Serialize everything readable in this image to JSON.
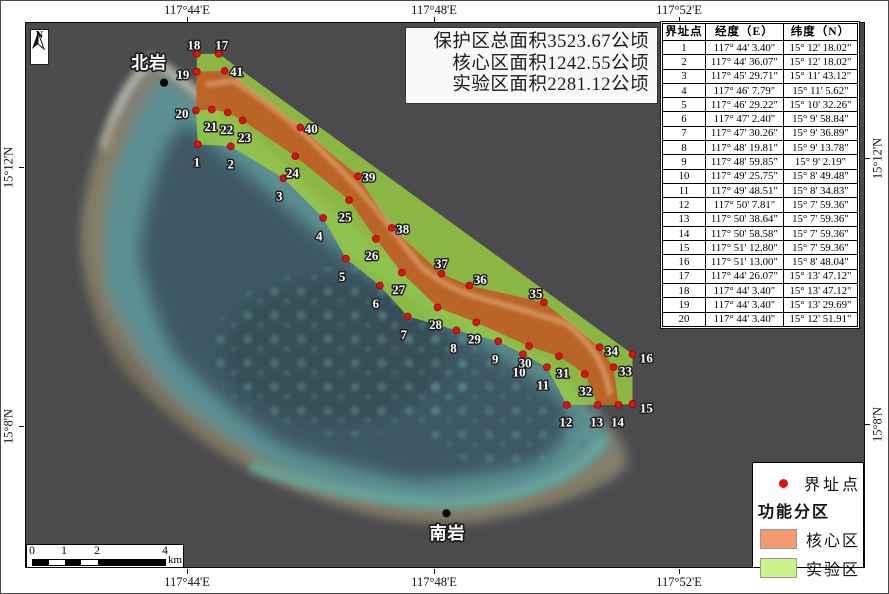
{
  "colors": {
    "map_background": "#4B4B4D",
    "core_zone_fill": "#BF5B25",
    "experimental_zone_fill": "#9BCE41",
    "legend_core_swatch": "#F49A73",
    "legend_experimental_swatch": "#CDF18A",
    "boundary_dot": "#DD1111"
  },
  "title_box": {
    "lines": [
      "保护区总面积3523.67公顷",
      "核心区面积1242.55公顷",
      "实验区面积2281.12公顷"
    ]
  },
  "north_arrow": {
    "label": "N"
  },
  "axes": {
    "top": [
      {
        "label": "117°44'E",
        "x": 187
      },
      {
        "label": "117°48'E",
        "x": 434
      },
      {
        "label": "117°52'E",
        "x": 679
      }
    ],
    "bottom": [
      {
        "label": "117°44'E",
        "x": 187
      },
      {
        "label": "117°48'E",
        "x": 434
      },
      {
        "label": "117°52'E",
        "x": 679
      }
    ],
    "left": [
      {
        "label": "15°12'N",
        "y": 167
      },
      {
        "label": "15°8'N",
        "y": 426
      }
    ],
    "right": [
      {
        "label": "15°12'N",
        "y": 158
      },
      {
        "label": "15°8'N",
        "y": 424
      }
    ]
  },
  "scale_bar": {
    "ticks": [
      {
        "label": "0",
        "x": 5
      },
      {
        "label": "1",
        "x": 37
      },
      {
        "label": "2",
        "x": 70
      },
      {
        "label": "4",
        "x": 138
      }
    ],
    "unit": "km",
    "segments": [
      {
        "x1": 5,
        "x2": 21
      },
      {
        "x1": 37,
        "x2": 53
      },
      {
        "x1": 70,
        "x2": 138
      }
    ]
  },
  "legend": {
    "point_label": "界址点",
    "group_title": "功能分区",
    "items": [
      {
        "label": "核心区",
        "color": "#F49A73"
      },
      {
        "label": "实验区",
        "color": "#CDF18A"
      }
    ]
  },
  "table": {
    "headers": [
      "界址点",
      "经度（E）",
      "纬度（N）"
    ],
    "rows": [
      [
        "1",
        "117° 44' 3.40\"",
        "15° 12' 18.02\""
      ],
      [
        "2",
        "117° 44' 36.07\"",
        "15° 12' 18.02\""
      ],
      [
        "3",
        "117° 45' 29.71\"",
        "15° 11' 43.12\""
      ],
      [
        "4",
        "117° 46' 7.79\"",
        "15° 11' 5.62\""
      ],
      [
        "5",
        "117° 46' 29.22\"",
        "15° 10' 32.26\""
      ],
      [
        "6",
        "117° 47' 2.40\"",
        "15° 9' 58.84\""
      ],
      [
        "7",
        "117° 47' 30.26\"",
        "15° 9' 36.89\""
      ],
      [
        "8",
        "117° 48' 19.81\"",
        "15° 9' 13.78\""
      ],
      [
        "9",
        "117° 48' 59.85\"",
        "15° 9' 2.19\""
      ],
      [
        "10",
        "117° 49' 25.75\"",
        "15° 8' 49.48\""
      ],
      [
        "11",
        "117° 49' 48.51\"",
        "15° 8' 34.83\""
      ],
      [
        "12",
        "117° 50' 7.81\"",
        "15° 7' 59.36\""
      ],
      [
        "13",
        "117° 50' 38.64\"",
        "15° 7' 59.36\""
      ],
      [
        "14",
        "117° 50' 58.58\"",
        "15° 7' 59.36\""
      ],
      [
        "15",
        "117° 51' 12.80\"",
        "15° 7' 59.36\""
      ],
      [
        "16",
        "117° 51' 13.00\"",
        "15° 8' 48.04\""
      ],
      [
        "17",
        "117° 44' 26.07\"",
        "15° 13' 47.12\""
      ],
      [
        "18",
        "117° 44' 3.40\"",
        "15° 13' 47.12\""
      ],
      [
        "19",
        "117° 44' 3.40\"",
        "15° 13' 29.69\""
      ],
      [
        "20",
        "117° 44' 3.40\"",
        "15° 12' 51.91\""
      ]
    ]
  },
  "map": {
    "zones": {
      "experimental_points": "171,31 193,31 609,333 609,383 595,384 574,384 543,384 523,346 499,333 474,320 432,309 383,295 355,264 321,237 298,196 258,156 205,124 172,122 170,88 171,49",
      "core_points": "171,49 199,48 275,105 333,154 367,206 417,252 445,264 520,281 576,326 590,346 595,384 574,384 561,353 535,335 505,325 452,301 413,286 377,251 351,217 324,178 270,134 217,98 202,90 186,87 170,88"
    },
    "boundary_points": [
      {
        "n": "1",
        "x": 172,
        "y": 122,
        "lx": 171,
        "ly": 140
      },
      {
        "n": "2",
        "x": 205,
        "y": 124,
        "lx": 205,
        "ly": 142
      },
      {
        "n": "3",
        "x": 258,
        "y": 156,
        "lx": 254,
        "ly": 174
      },
      {
        "n": "4",
        "x": 298,
        "y": 196,
        "lx": 294,
        "ly": 214
      },
      {
        "n": "5",
        "x": 321,
        "y": 237,
        "lx": 317,
        "ly": 255
      },
      {
        "n": "6",
        "x": 355,
        "y": 264,
        "lx": 351,
        "ly": 282
      },
      {
        "n": "7",
        "x": 383,
        "y": 295,
        "lx": 379,
        "ly": 313
      },
      {
        "n": "8",
        "x": 432,
        "y": 309,
        "lx": 429,
        "ly": 327
      },
      {
        "n": "9",
        "x": 474,
        "y": 320,
        "lx": 471,
        "ly": 338
      },
      {
        "n": "10",
        "x": 499,
        "y": 333,
        "lx": 495,
        "ly": 351
      },
      {
        "n": "11",
        "x": 523,
        "y": 346,
        "lx": 519,
        "ly": 364
      },
      {
        "n": "12",
        "x": 543,
        "y": 384,
        "lx": 542,
        "ly": 401
      },
      {
        "n": "13",
        "x": 574,
        "y": 384,
        "lx": 573,
        "ly": 401
      },
      {
        "n": "14",
        "x": 595,
        "y": 384,
        "lx": 594,
        "ly": 401
      },
      {
        "n": "15",
        "x": 609,
        "y": 383,
        "lx": 623,
        "ly": 387
      },
      {
        "n": "16",
        "x": 609,
        "y": 333,
        "lx": 623,
        "ly": 337
      },
      {
        "n": "17",
        "x": 193,
        "y": 31,
        "lx": 196,
        "ly": 22
      },
      {
        "n": "18",
        "x": 171,
        "y": 31,
        "lx": 168,
        "ly": 22
      },
      {
        "n": "19",
        "x": 171,
        "y": 49,
        "lx": 157,
        "ly": 52
      },
      {
        "n": "20",
        "x": 170,
        "y": 88,
        "lx": 156,
        "ly": 91
      },
      {
        "n": "21",
        "x": 186,
        "y": 87,
        "lx": 185,
        "ly": 104
      },
      {
        "n": "22",
        "x": 202,
        "y": 90,
        "lx": 201,
        "ly": 107
      },
      {
        "n": "23",
        "x": 217,
        "y": 98,
        "lx": 219,
        "ly": 115
      },
      {
        "n": "24",
        "x": 270,
        "y": 134,
        "lx": 267,
        "ly": 151
      },
      {
        "n": "25",
        "x": 324,
        "y": 178,
        "lx": 320,
        "ly": 195
      },
      {
        "n": "26",
        "x": 351,
        "y": 217,
        "lx": 347,
        "ly": 234
      },
      {
        "n": "27",
        "x": 377,
        "y": 251,
        "lx": 374,
        "ly": 268
      },
      {
        "n": "28",
        "x": 413,
        "y": 286,
        "lx": 411,
        "ly": 303
      },
      {
        "n": "29",
        "x": 452,
        "y": 301,
        "lx": 450,
        "ly": 318
      },
      {
        "n": "30",
        "x": 505,
        "y": 325,
        "lx": 501,
        "ly": 342
      },
      {
        "n": "31",
        "x": 535,
        "y": 335,
        "lx": 539,
        "ly": 352
      },
      {
        "n": "32",
        "x": 561,
        "y": 353,
        "lx": 562,
        "ly": 370
      },
      {
        "n": "33",
        "x": 590,
        "y": 346,
        "lx": 602,
        "ly": 350
      },
      {
        "n": "34",
        "x": 576,
        "y": 326,
        "lx": 588,
        "ly": 330
      },
      {
        "n": "35",
        "x": 520,
        "y": 281,
        "lx": 512,
        "ly": 272
      },
      {
        "n": "36",
        "x": 445,
        "y": 264,
        "lx": 456,
        "ly": 258
      },
      {
        "n": "37",
        "x": 417,
        "y": 252,
        "lx": 417,
        "ly": 242
      },
      {
        "n": "38",
        "x": 367,
        "y": 206,
        "lx": 378,
        "ly": 207
      },
      {
        "n": "39",
        "x": 333,
        "y": 154,
        "lx": 344,
        "ly": 155
      },
      {
        "n": "40",
        "x": 275,
        "y": 105,
        "lx": 286,
        "ly": 106
      },
      {
        "n": "41",
        "x": 199,
        "y": 48,
        "lx": 211,
        "ly": 49
      }
    ],
    "place_labels": [
      {
        "name": "北岩",
        "x": 123,
        "y": 40,
        "dot_x": 138,
        "dot_y": 60
      },
      {
        "name": "南岩",
        "x": 423,
        "y": 513,
        "dot_x": 422,
        "dot_y": 493
      }
    ]
  }
}
